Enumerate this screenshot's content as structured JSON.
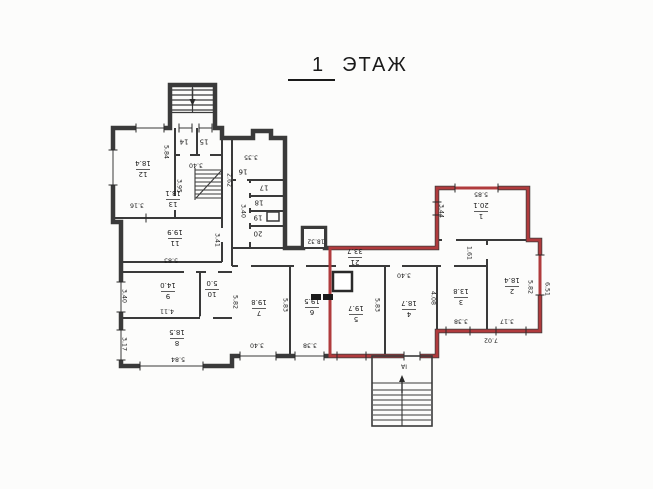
{
  "title": {
    "floor_number": "1",
    "floor_word": "ЭТАЖ"
  },
  "colors": {
    "wall": "#3a3a3a",
    "highlight": "#b03b3d",
    "background": "#fcfcfb",
    "text": "#1b1b1b"
  },
  "rooms": [
    {
      "number": "1",
      "area": "20.1"
    },
    {
      "number": "2",
      "area": "18.4"
    },
    {
      "number": "3",
      "area": "13.8"
    },
    {
      "number": "4",
      "area": "18.7"
    },
    {
      "number": "5",
      "area": "19.7"
    },
    {
      "number": "6",
      "area": "19.5"
    },
    {
      "number": "7",
      "area": "19.8"
    },
    {
      "number": "8",
      "area": "18.5"
    },
    {
      "number": "9",
      "area": "14.0"
    },
    {
      "number": "10",
      "area": "5.0"
    },
    {
      "number": "11",
      "area": "19.9"
    },
    {
      "number": "12",
      "area": "18.4"
    },
    {
      "number": "13",
      "area": "13.1"
    },
    {
      "number": "14",
      "area": ""
    },
    {
      "number": "15",
      "area": ""
    },
    {
      "number": "16",
      "area": ""
    },
    {
      "number": "17",
      "area": ""
    },
    {
      "number": "18",
      "area": ""
    },
    {
      "number": "19",
      "area": ""
    },
    {
      "number": "20",
      "area": ""
    },
    {
      "number": "21",
      "area": "33.7"
    }
  ],
  "annotations": {
    "shaft_area": "18.32",
    "porch_label": "ІА"
  },
  "dimensions": {
    "room12_width": "5.84",
    "room12_bottom": "3.16",
    "room13_height": "3.95",
    "room13_top": "3.40",
    "block_height": "2.62",
    "block_top": "3.35",
    "block_lower_height": "3.40",
    "room11_bottom": "5.83",
    "room11_side": "3.41",
    "room9_side": "3.40",
    "room9_bottom": "4.11",
    "room8_side": "3.17",
    "room8_bottom": "5.84",
    "room7_side": "5.82",
    "room7_bottom": "3.40",
    "room6_side": "5.83",
    "room6_bottom": "3.38",
    "room5_side": "5.83",
    "room4_top": "3.40",
    "room1_top": "5.85",
    "room1_side": "3.44",
    "corridor_wall": "1.61",
    "room3_side": "4.08",
    "room3_bottom": "3.38",
    "room2_side": "5.82",
    "room2_bottom": "3.17",
    "outer_right": "6.51",
    "outer_bottom": "7.02"
  }
}
